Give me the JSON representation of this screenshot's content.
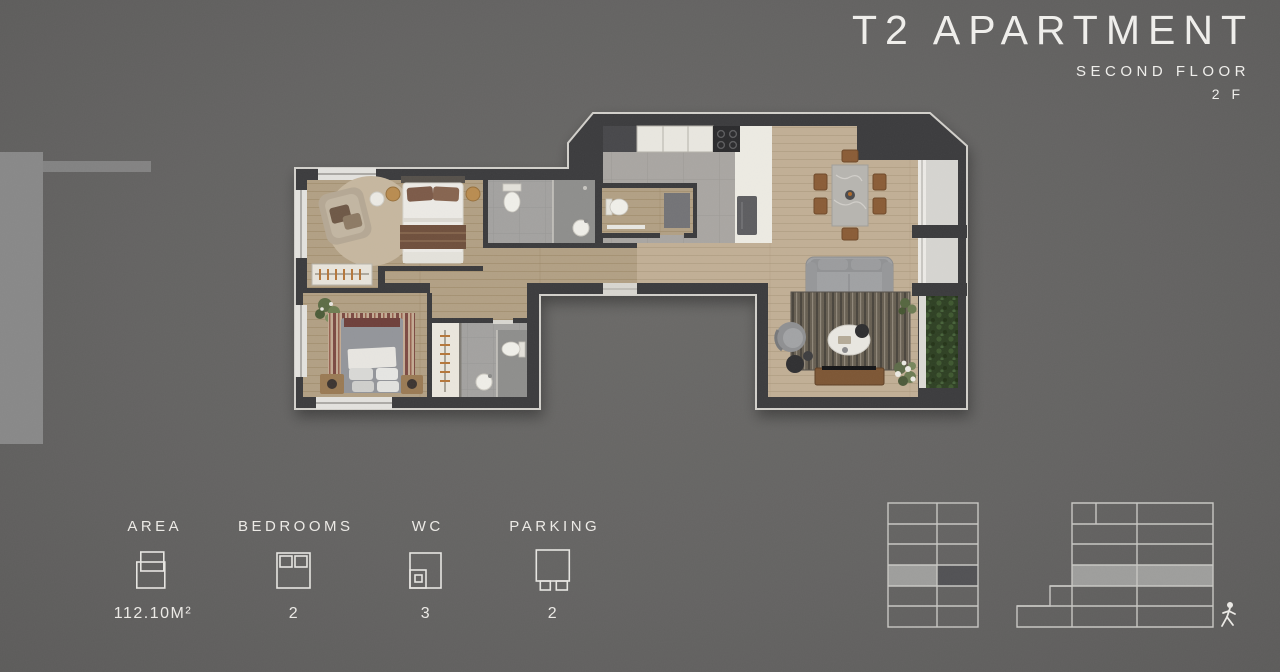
{
  "title": {
    "main": "T2 APARTMENT",
    "floor_name": "SECOND FLOOR",
    "floor_short": "2 F"
  },
  "legend": {
    "items": [
      {
        "label": "AREA",
        "value": "112.10M²",
        "icon": "area-icon"
      },
      {
        "label": "BEDROOMS",
        "value": "2",
        "icon": "bedrooms-icon"
      },
      {
        "label": "WC",
        "value": "3",
        "icon": "wc-icon"
      },
      {
        "label": "PARKING",
        "value": "2",
        "icon": "parking-icon"
      }
    ]
  },
  "floor_plan": {
    "rooms": [
      "bedroom-1",
      "bathroom-1",
      "bedroom-2",
      "wardrobe",
      "bathroom-2",
      "hallway",
      "guest-wc",
      "kitchen",
      "living-dining-room",
      "balcony-planter"
    ]
  },
  "building_diagrams": {
    "left_tower": {
      "floors": 6,
      "units_per_floor": 2,
      "highlighted_floor_from_top": 4
    },
    "right_tower": {
      "floors": 6,
      "stepped": true,
      "highlighted_floor_from_top": 4
    }
  },
  "colors": {
    "background": "#646362",
    "wall": "#3a3a3c",
    "outline": "#d2d0cb",
    "text": "#efeeeb",
    "wood_living": "#c1af95",
    "wood_bedroom": "#b2a084",
    "tile": "#a3a2a0",
    "planter_green": "#2e4023",
    "highlight": "#9e9e9c"
  }
}
